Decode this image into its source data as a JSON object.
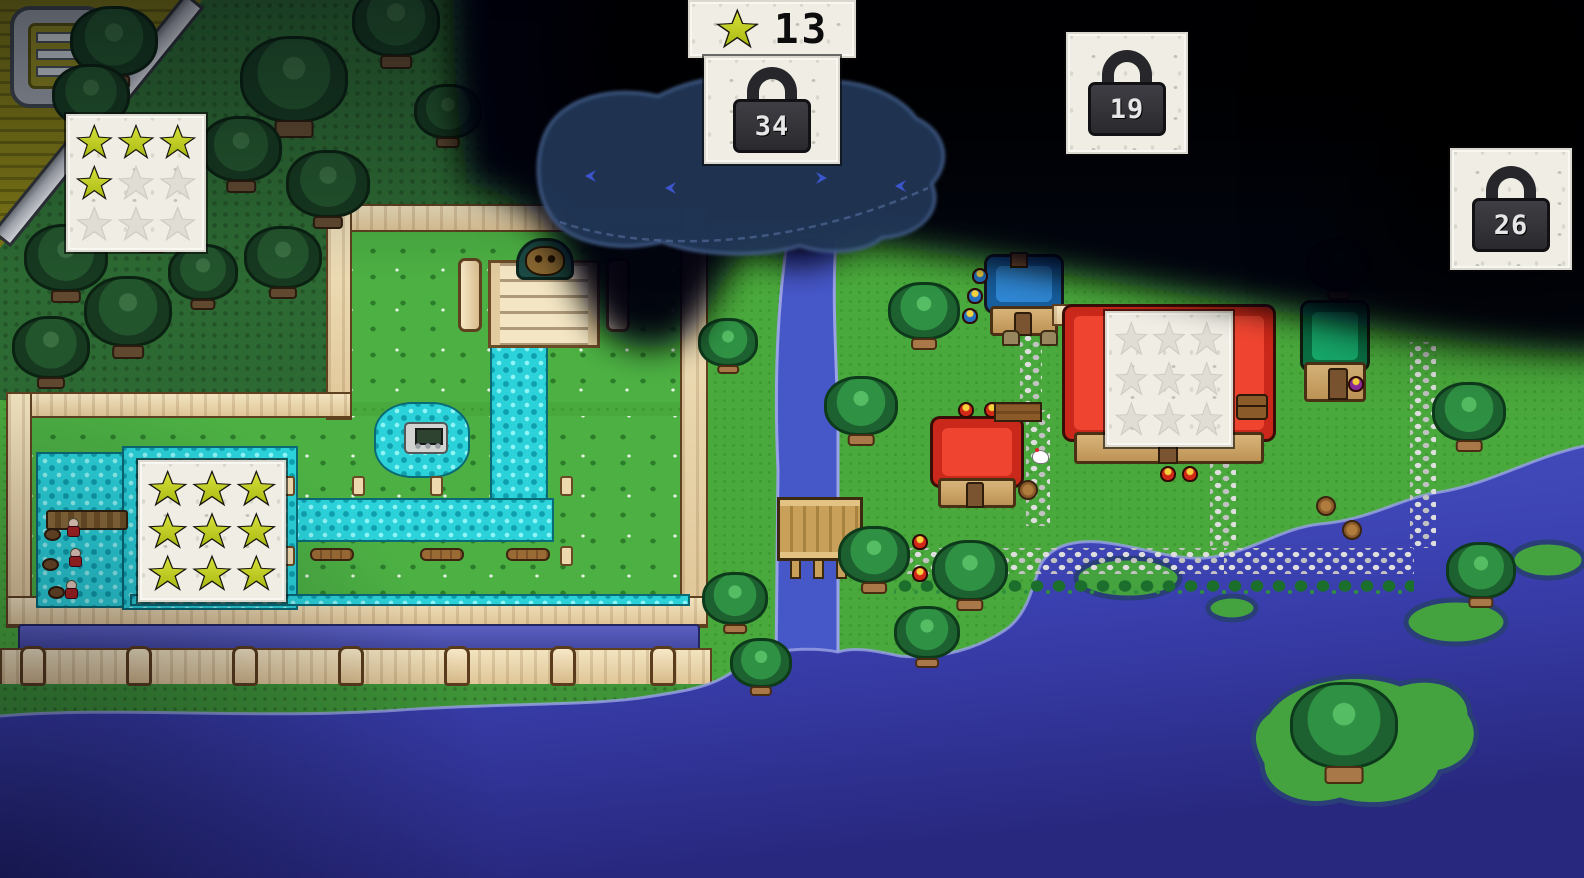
{
  "hud": {
    "star_counter": {
      "icon": "star-icon",
      "value": "13"
    },
    "locks": [
      {
        "icon": "padlock-icon",
        "value": "34"
      },
      {
        "icon": "padlock-icon",
        "value": "19"
      },
      {
        "icon": "padlock-icon",
        "value": "26"
      }
    ]
  },
  "star_panels": [
    {
      "id": "forest-star-panel",
      "filled": 4,
      "total": 9
    },
    {
      "id": "garden-star-panel",
      "filled": 9,
      "total": 9
    },
    {
      "id": "village-roof-star-panel",
      "filled": 0,
      "total": 9
    }
  ],
  "colors": {
    "star_yellow": "#bfcf1c",
    "lock_body": "#323236",
    "paper": "#efede4",
    "grass_village": "#4aa93c",
    "grass_forest": "#2d6a33",
    "water_canal": "#2bd2da",
    "water_river": "#4657c8",
    "water_ocean_deep": "#2a2a8a",
    "roof_red": "#e23420",
    "roof_blue": "#1f74c0",
    "roof_green": "#0f9156",
    "wall_sand": "#ecd8ae"
  }
}
